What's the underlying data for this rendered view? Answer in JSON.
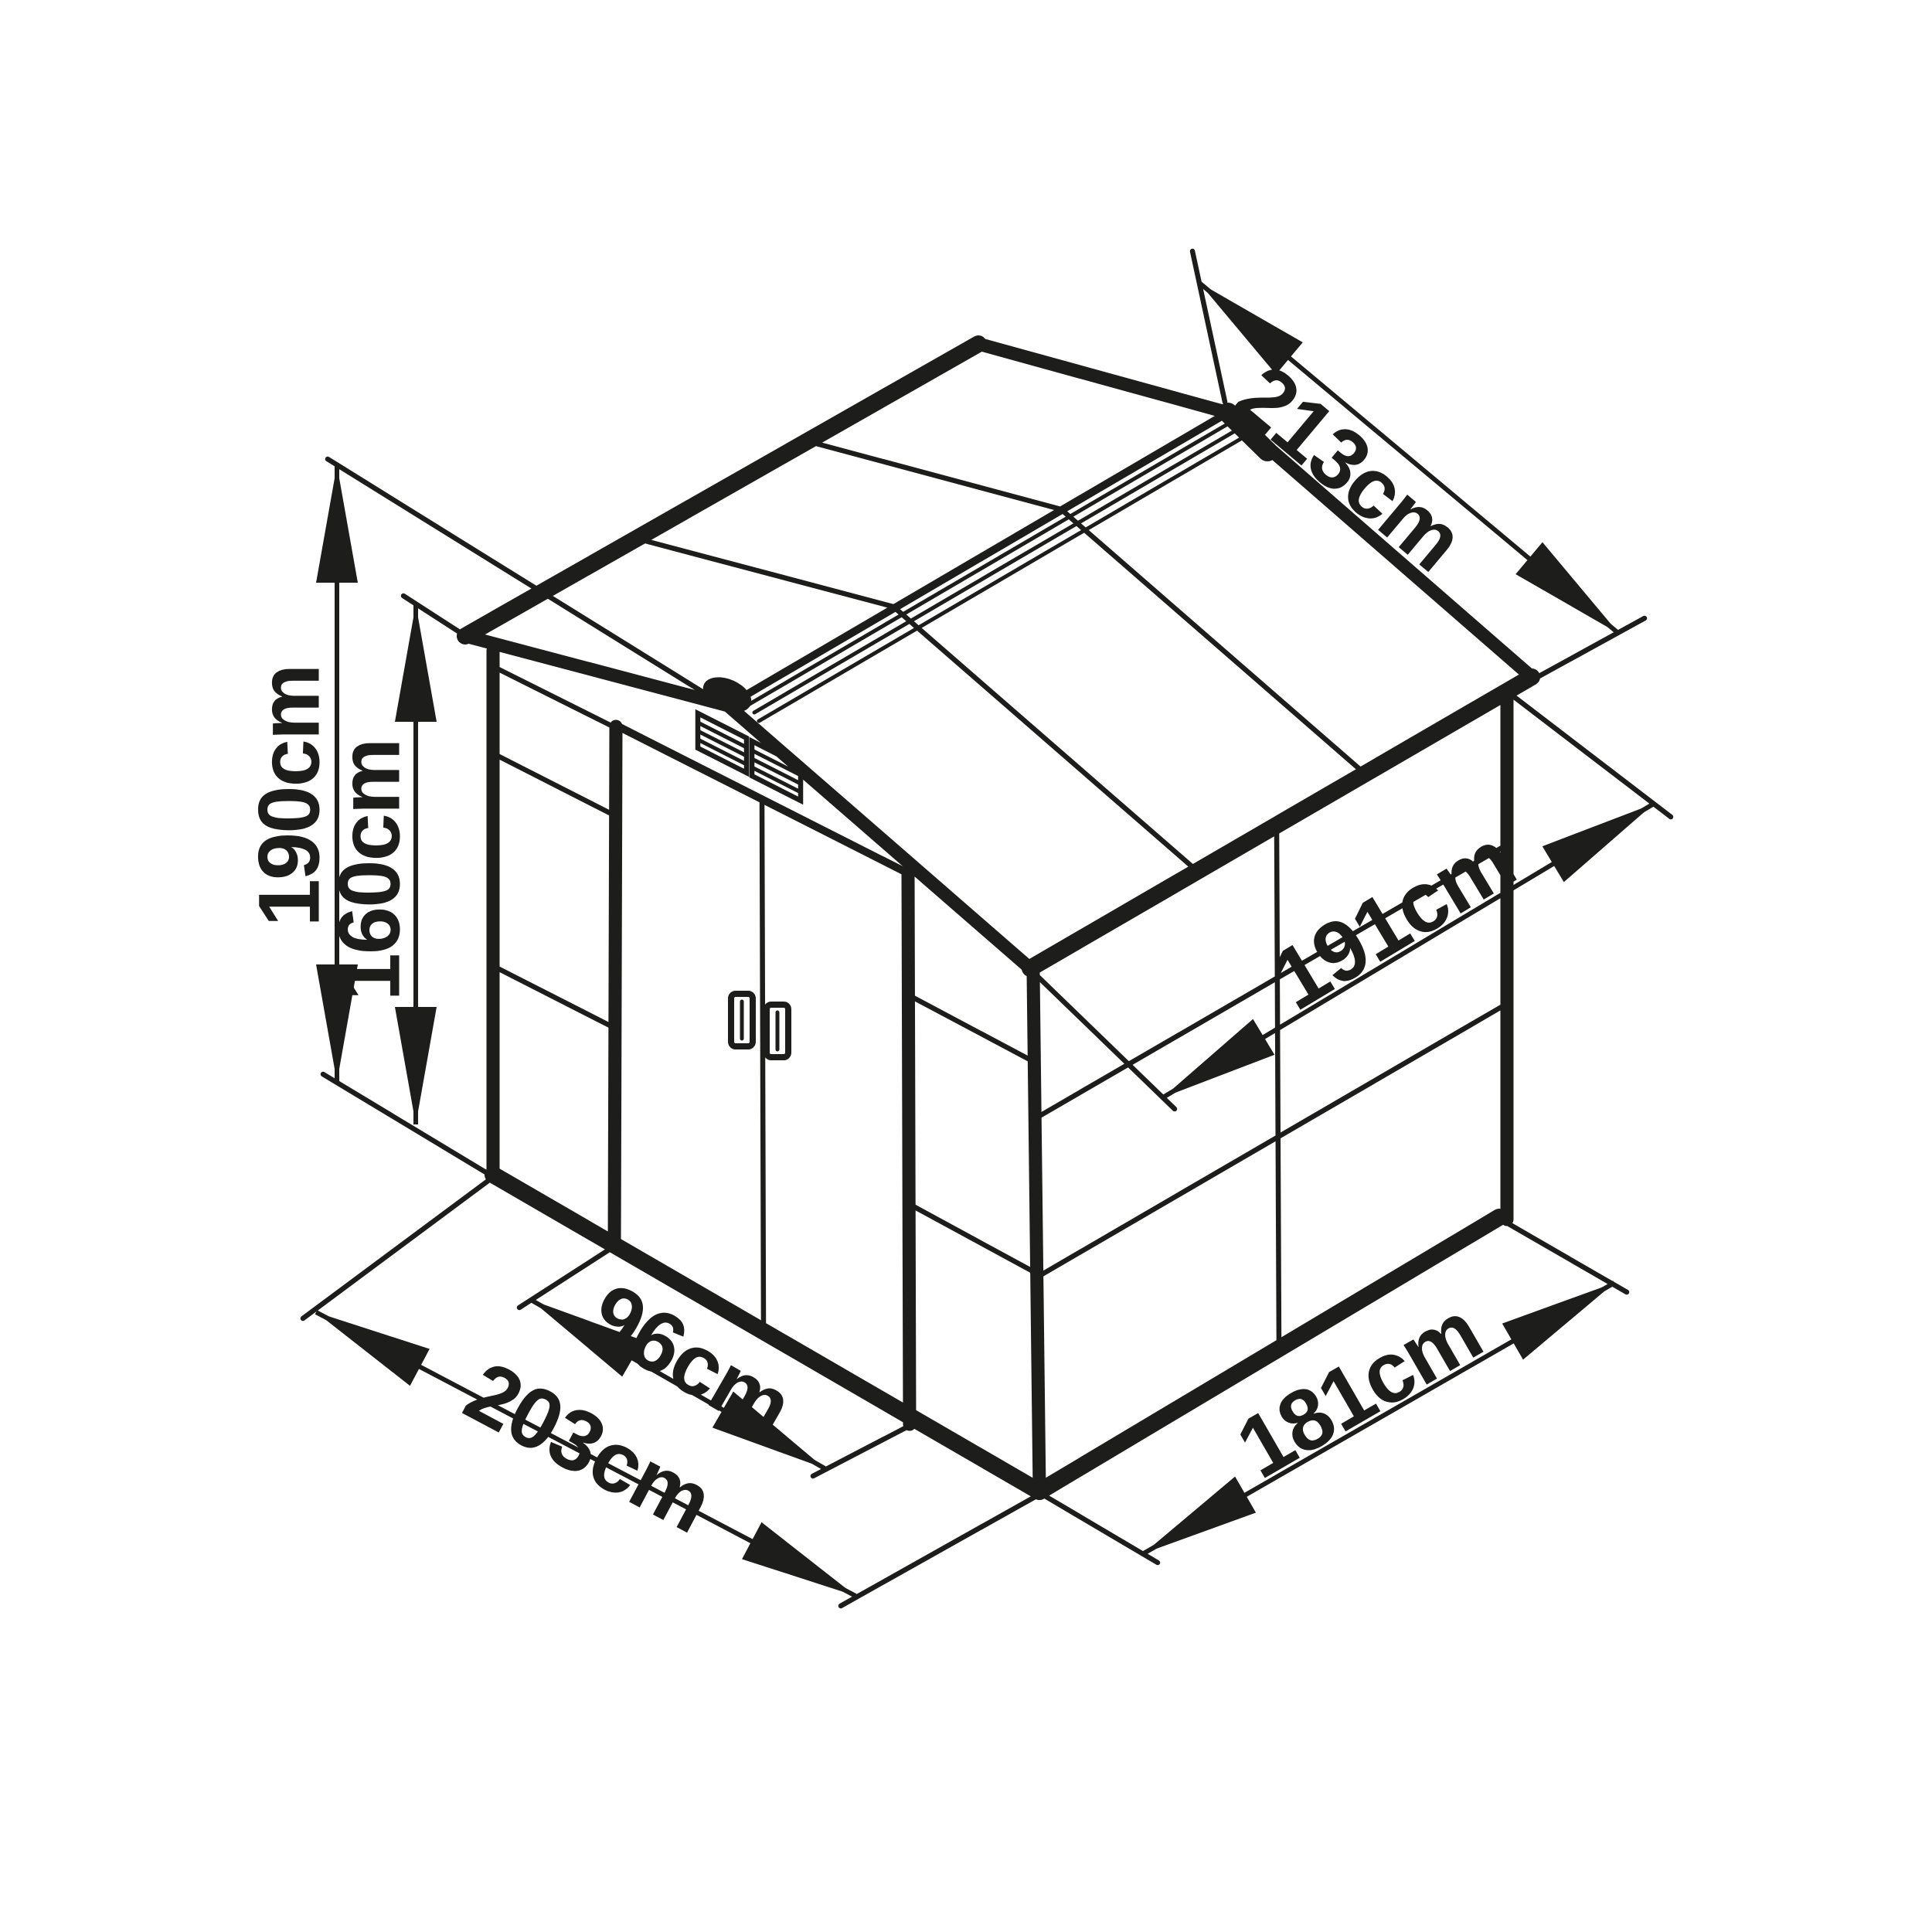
{
  "page": {
    "background": "#ffffff",
    "ink_color": "#1d1d1b",
    "description": "isometric technical line drawing of a gable-roof garden shed with dimension arrows"
  },
  "diagram": {
    "object": "garden-shed",
    "view": "isometric",
    "unit": "cm",
    "dimensions": {
      "total_height": {
        "label": "190cm",
        "value": 190,
        "measures": "ground to roof ridge"
      },
      "eave_height": {
        "label": "160cm",
        "value": 160,
        "measures": "ground to roof eave"
      },
      "roof_slope": {
        "label": "213cm",
        "value": 213,
        "measures": "roof slope width"
      },
      "inner_depth": {
        "label": "191cm",
        "value": 191,
        "measures": "side wall diagonal depth"
      },
      "door_width": {
        "label": "96cm",
        "value": 96,
        "measures": "double door opening width"
      },
      "front_width": {
        "label": "203cm",
        "value": 203,
        "measures": "front wall base width"
      },
      "side_depth": {
        "label": "181cm",
        "value": 181,
        "measures": "side wall base depth"
      }
    }
  }
}
